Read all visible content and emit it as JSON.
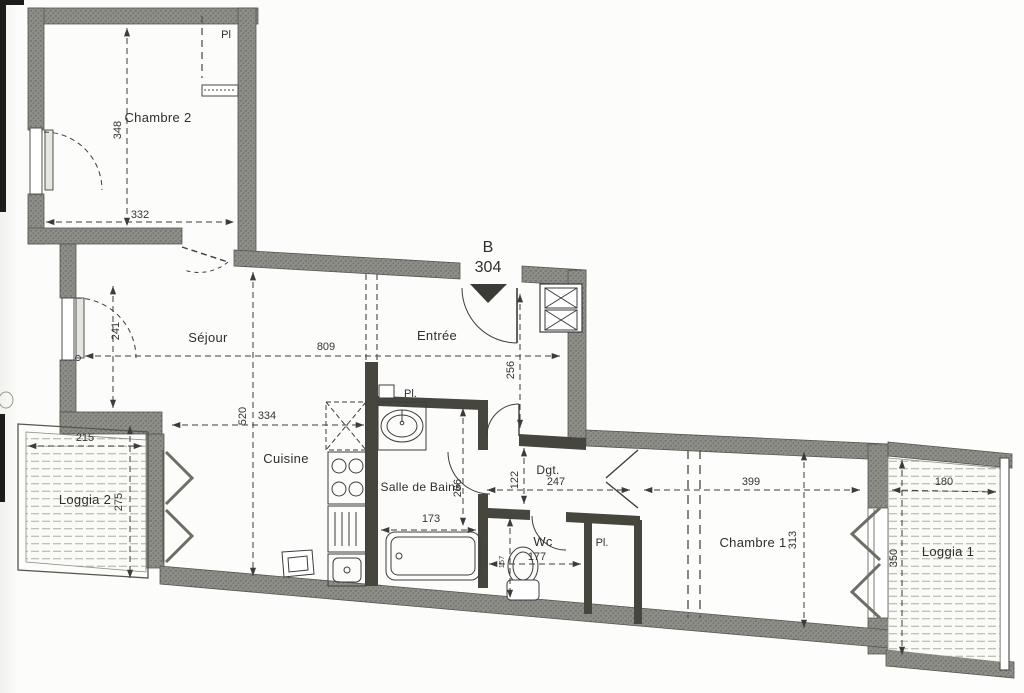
{
  "unit": {
    "block": "B",
    "number": "304"
  },
  "rooms": {
    "chambre2": {
      "label": "Chambre 2",
      "width": "332",
      "height": "348",
      "closet": "Pl"
    },
    "sejour": {
      "label": "Séjour",
      "width": "809",
      "window_height": "241",
      "depth": "520",
      "kitchen_width": "334"
    },
    "entree": {
      "label": "Entrée",
      "depth": "256"
    },
    "cuisine": {
      "label": "Cuisine"
    },
    "salle_de_bains": {
      "label": "Salle de Bains",
      "width": "173",
      "depth": "266",
      "closet": "Pl."
    },
    "degagement": {
      "label": "Dgt.",
      "width": "247",
      "depth": "122"
    },
    "wc": {
      "label": "Wc",
      "width": "177",
      "depth": "157"
    },
    "placard_couloir": {
      "label": "Pl."
    },
    "chambre1": {
      "label": "Chambre 1",
      "width": "399",
      "depth": "313"
    },
    "loggia1": {
      "label": "Loggia 1",
      "width": "180",
      "depth": "350"
    },
    "loggia2": {
      "label": "Loggia 2",
      "width": "215",
      "depth": "275"
    }
  },
  "colors": {
    "wall": "#90908a",
    "line": "#3c3c3c",
    "paper": "#fcfcfa"
  }
}
